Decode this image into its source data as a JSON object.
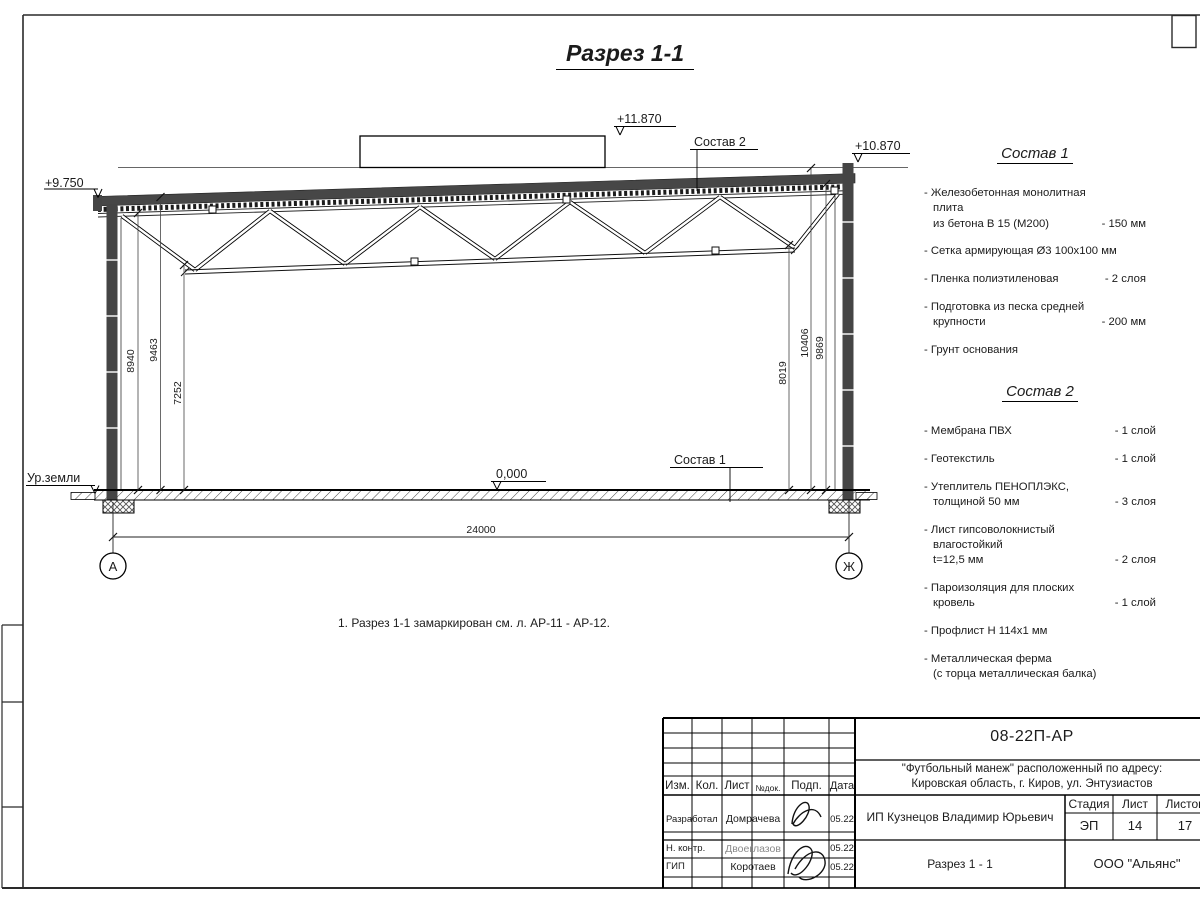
{
  "drawing": {
    "title": "Разрез 1-1",
    "note": "1. Разрез 1-1 замаркирован см. л. АР-11 - АР-12.",
    "ground_label": "Ур.земли",
    "elevations": {
      "roof_left": "+9.750",
      "parapet": "+11.870",
      "roof_right": "+10.870",
      "floor": "0,000"
    },
    "leaders": {
      "sostav1": "Состав 1",
      "sostav2": "Состав 2"
    },
    "dimensions": {
      "left": [
        "8940",
        "9463",
        "7252"
      ],
      "right": [
        "8019",
        "10406",
        "9869"
      ],
      "span": "24000"
    },
    "axes": {
      "left": "А",
      "right": "Ж"
    }
  },
  "sostav1": {
    "title": "Состав 1",
    "items": [
      {
        "name": "- Железобетонная  монолитная плита\nиз бетона В 15 (М200)",
        "value": "- 150 мм"
      },
      {
        "name": "- Сетка армирующая Ø3 100x100 мм",
        "value": ""
      },
      {
        "name": "- Пленка полиэтиленовая",
        "value": "- 2 слоя"
      },
      {
        "name": "- Подготовка из песка средней\nкрупности",
        "value": "- 200 мм"
      },
      {
        "name": "- Грунт основания",
        "value": ""
      }
    ]
  },
  "sostav2": {
    "title": "Состав 2",
    "items": [
      {
        "name": "- Мембрана ПВХ",
        "value": "- 1 слой"
      },
      {
        "name": "- Геотекстиль",
        "value": "- 1 слой"
      },
      {
        "name": "- Утеплитель ПЕНОПЛЭКС,\nтолщиной 50 мм",
        "value": "- 3 слоя"
      },
      {
        "name": "- Лист гипсоволокнистый влагостойкий\nt=12,5 мм",
        "value": "- 2 слоя"
      },
      {
        "name": "- Пароизоляция для плоских кровель",
        "value": "- 1 слой"
      },
      {
        "name": "- Профлист Н 114х1 мм",
        "value": ""
      },
      {
        "name": "- Металлическая ферма\n(с торца металлическая балка)",
        "value": ""
      }
    ]
  },
  "stamp": {
    "doc_number": "08-22П-АР",
    "project": "\"Футбольный манеж\" расположенный по адресу:\nКировская область, г. Киров, ул. Энтузиастов",
    "client": "ИП Кузнецов Владимир Юрьевич",
    "sheet_title": "Разрез 1 - 1",
    "company": "ООО \"Альянс\"",
    "columns": [
      "Изм.",
      "Кол.",
      "Лист",
      "№док.",
      "Подп.",
      "Дата"
    ],
    "stage_label": "Стадия",
    "sheet_label": "Лист",
    "sheets_label": "Листов",
    "stage": "ЭП",
    "sheet": "14",
    "sheets": "17",
    "rows": [
      {
        "role": "Разработал",
        "name": "Домрачева",
        "date": "05.22"
      },
      {
        "role": "Н. контр.",
        "name": "Двоеглазов",
        "date": "05.22"
      },
      {
        "role": "ГИП",
        "name": "Коротаев",
        "date": "05.22"
      }
    ]
  }
}
